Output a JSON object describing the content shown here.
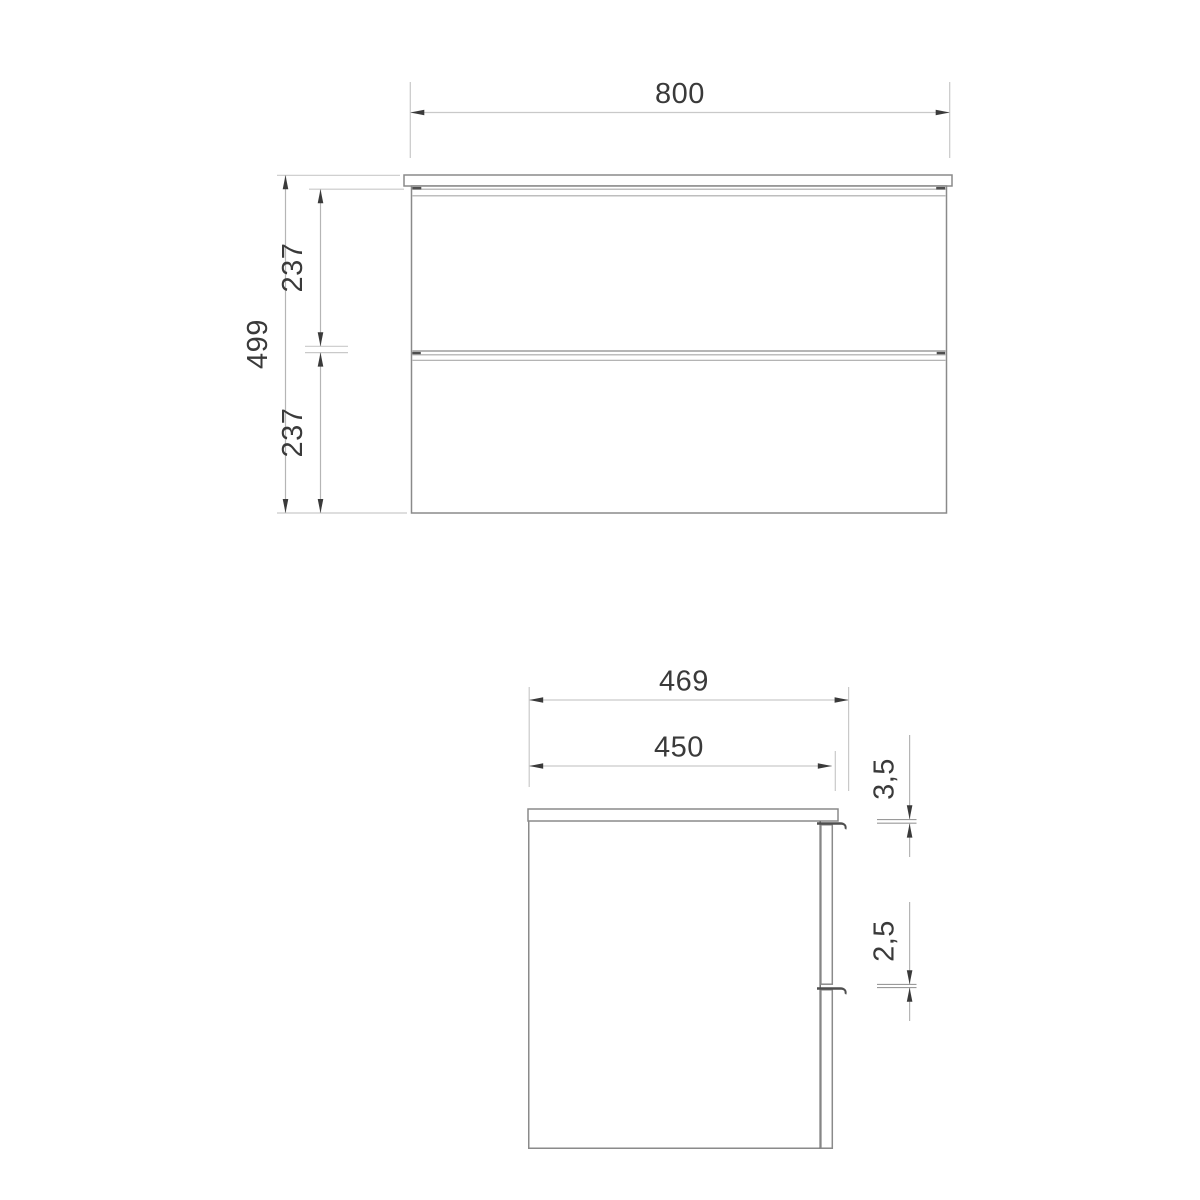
{
  "drawing": {
    "type": "technical-drawing",
    "subject": "two-drawer vanity cabinet, front elevation and side section",
    "background_color": "#ffffff",
    "outline_color": "#8a8a8a",
    "dimension_line_color": "#c9c9c9",
    "arrow_color": "#3a3a3a",
    "text_color": "#3a3a3a",
    "front_view": {
      "width_label": "800",
      "height_label": "499",
      "drawer1_height_label": "237",
      "drawer2_height_label": "237"
    },
    "side_view": {
      "outer_depth_label": "469",
      "body_depth_label": "450",
      "top_gap_label": "3,5",
      "drawer_gap_label": "2,5"
    }
  }
}
